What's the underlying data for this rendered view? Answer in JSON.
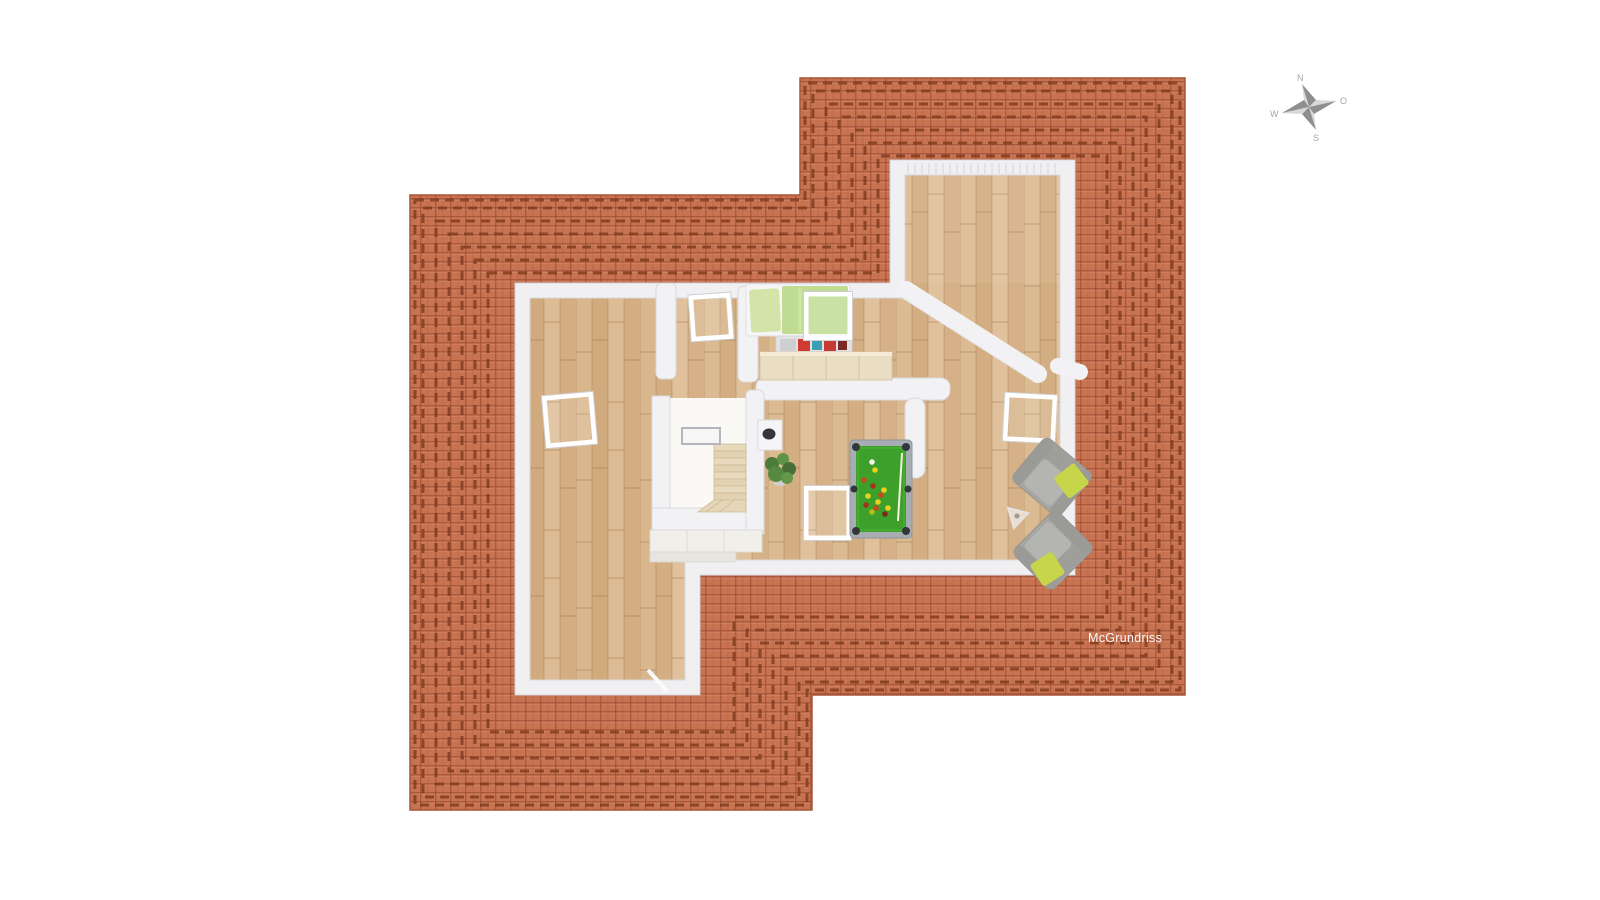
{
  "watermark": {
    "label": "McGrundriss"
  },
  "compass": {
    "north": "N",
    "east": "O",
    "south": "S",
    "west": "W"
  },
  "palette": {
    "roof_tile": "#c87351",
    "roof_tile_gap": "#a95a3c",
    "roof_ridge": "#7e3a1e",
    "wall": "#f2f2f4",
    "wall_edge": "#d9d9dc",
    "floor_wood": "#d9b78d",
    "stair_tread": "#e8dabd",
    "pool_felt": "#3da02a",
    "pool_frame": "#a7adb3",
    "pool_pocket": "#33373b",
    "armchair_gray": "#a6a6a2",
    "cushion_green": "#c7d54b",
    "bed_blanket": "#bfdc92",
    "bed_pillow": "#d3e4a9",
    "plant_green": "#4c7c3c",
    "sideboard_wood": "#e9ddc4"
  },
  "scene": {
    "type": "3d-floor-plan-top-view",
    "elements": [
      "tiled-roof",
      "wood-floor",
      "perimeter-walls",
      "bedroom",
      "hall",
      "left-room",
      "game-room",
      "gallery-room",
      "staircase",
      "railing",
      "chimney",
      "bed",
      "clothes-shelf",
      "sideboard",
      "pool-table",
      "armchair",
      "armchair",
      "floor-lamp",
      "potted-plant",
      "skylight-windows",
      "door-leaf",
      "compass-rose"
    ]
  }
}
